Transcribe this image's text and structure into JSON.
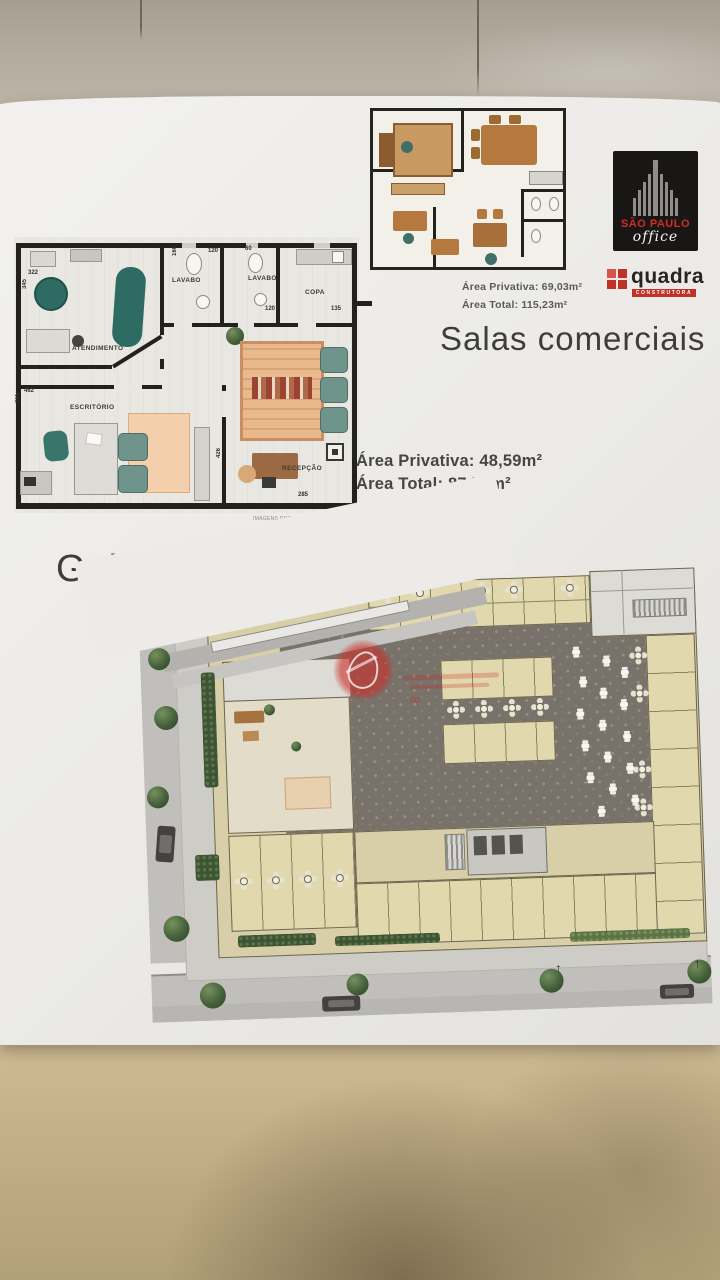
{
  "branding": {
    "building_name_line1": "SÃO PAULO",
    "building_name_line2": "office",
    "developer_name": "quadra",
    "developer_tagline": "CONSTRUTORA",
    "brand_red": "#c23127",
    "logo_background": "#181715"
  },
  "sections": {
    "commercial_title": "Salas comerciais",
    "gallery_title": "Galeria"
  },
  "top_plan": {
    "area_privativa": "Área Privativa: 69,03m²",
    "area_total": "Área Total: 115,23m²"
  },
  "main_plan": {
    "area_privativa": "Área Privativa: 48,59m²",
    "area_total": "Área Total: 87,79m²",
    "disclaimer": "IMAGENS DOS MÓVEIS ILUSTRATIVAS",
    "rooms": {
      "atendimento": "ATENDIMENTO",
      "escritorio": "ESCRITÓRIO",
      "lavabo1": "LAVABO",
      "lavabo2": "LAVABO",
      "copa": "COPA",
      "recepcao": "RECEPÇÃO"
    },
    "dimensions": {
      "d322": "322",
      "d345": "345",
      "d160": "160",
      "d120a": "120",
      "d60": "60",
      "d120b": "120",
      "d135": "135",
      "d462": "462",
      "d265": "265",
      "d426": "426",
      "d285": "285"
    }
  },
  "gallery_plan": {
    "unit_color": "#e2d8ae",
    "courtyard_color": "#79726a",
    "watermark_color": "#cc2c26"
  }
}
